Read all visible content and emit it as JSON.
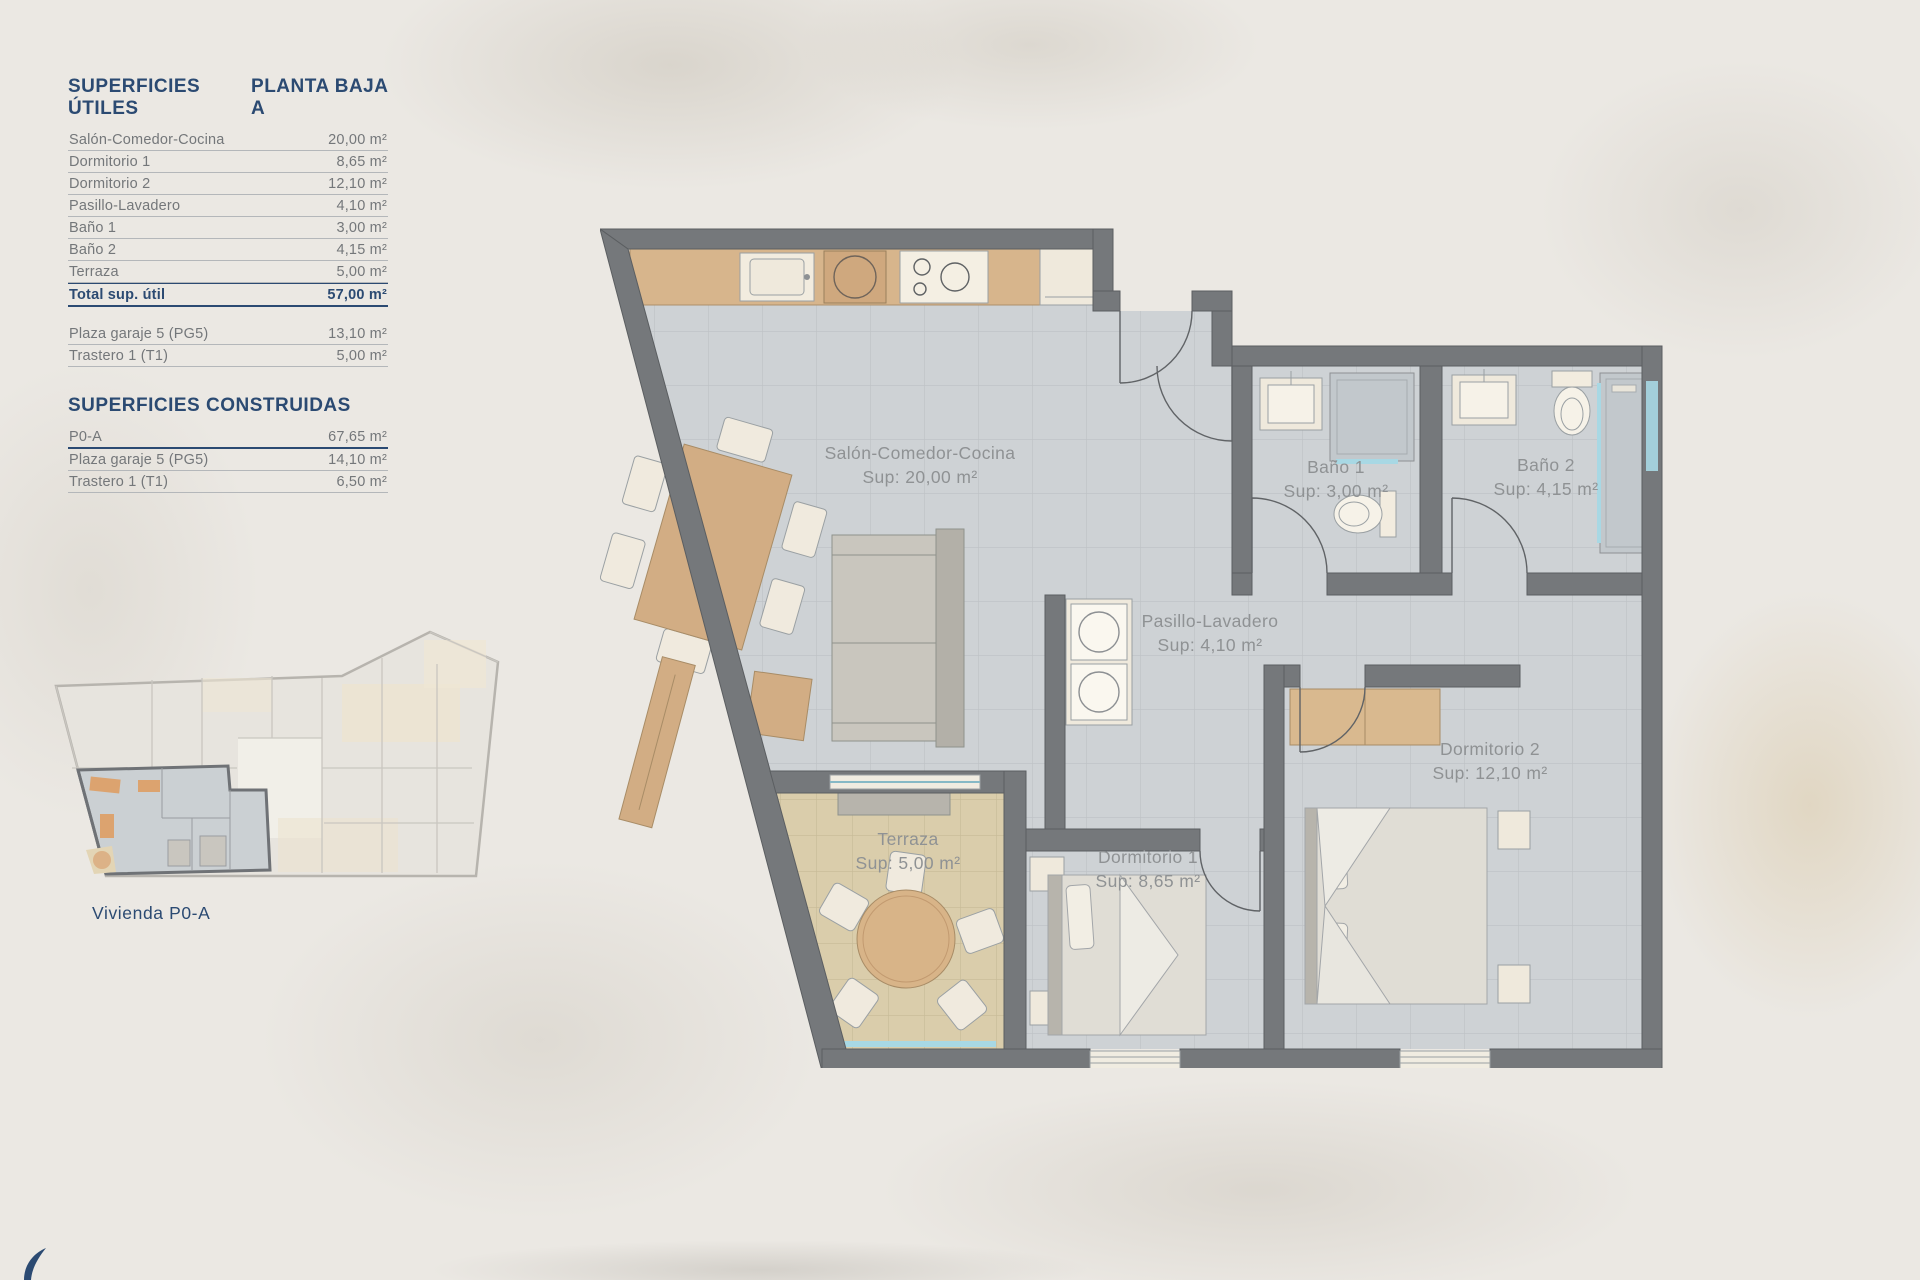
{
  "header": {
    "title_left": "SUPERFICIES ÚTILES",
    "title_right": "PLANTA BAJA A"
  },
  "useful_table": {
    "rows": [
      {
        "label": "Salón-Comedor-Cocina",
        "value": "20,00 m²"
      },
      {
        "label": "Dormitorio 1",
        "value": "8,65 m²"
      },
      {
        "label": "Dormitorio 2",
        "value": "12,10 m²"
      },
      {
        "label": "Pasillo-Lavadero",
        "value": "4,10 m²"
      },
      {
        "label": "Baño 1",
        "value": "3,00 m²"
      },
      {
        "label": "Baño 2",
        "value": "4,15 m²"
      },
      {
        "label": "Terraza",
        "value": "5,00 m²"
      }
    ],
    "total": {
      "label": "Total sup. útil",
      "value": "57,00 m²"
    },
    "annex_rows": [
      {
        "label": "Plaza garaje 5 (PG5)",
        "value": "13,10 m²"
      },
      {
        "label": "Trastero 1 (T1)",
        "value": "5,00 m²"
      }
    ]
  },
  "built_table": {
    "title": "SUPERFICIES CONSTRUIDAS",
    "rows": [
      {
        "label": "P0-A",
        "value": "67,65 m²"
      },
      {
        "label": "Plaza garaje 5 (PG5)",
        "value": "14,10 m²"
      },
      {
        "label": "Trastero 1 (T1)",
        "value": "6,50 m²"
      }
    ]
  },
  "overview": {
    "caption": "Vivienda P0-A"
  },
  "floorplan": {
    "rooms": [
      {
        "name": "Salón-Comedor-Cocina",
        "sup": "Sup: 20,00 m²"
      },
      {
        "name": "Baño 1",
        "sup": "Sup: 3,00 m²"
      },
      {
        "name": "Baño 2",
        "sup": "Sup: 4,15 m²"
      },
      {
        "name": "Pasillo-Lavadero",
        "sup": "Sup: 4,10 m²"
      },
      {
        "name": "Dormitorio 1",
        "sup": "Sup: 8,65 m²"
      },
      {
        "name": "Dormitorio 2",
        "sup": "Sup: 12,10 m²"
      },
      {
        "name": "Terraza",
        "sup": "Sup: 5,00 m²"
      }
    ]
  },
  "colors": {
    "accent_navy": "#2b4a72",
    "wall_gray": "#75787b",
    "floor_tile": "#ced2d5",
    "terrace_tile": "#dacdab",
    "wood": "#d7b58c",
    "water_blue": "#a8d8e4",
    "label_gray": "#8f9294"
  }
}
